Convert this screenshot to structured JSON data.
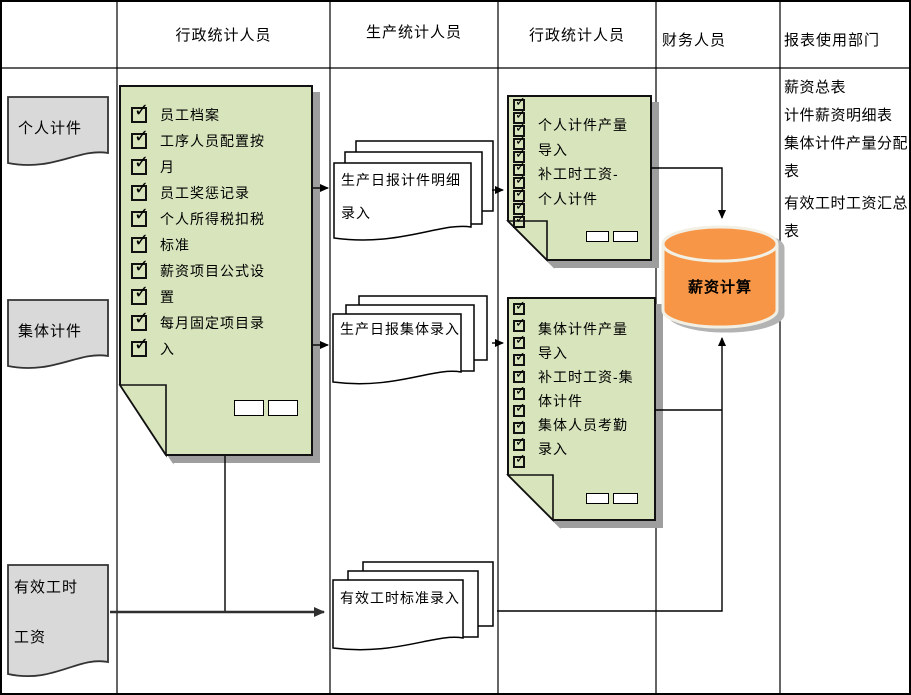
{
  "header": {
    "lanes": [
      "行政统计人员",
      "生产统计人员",
      "行政统计人员",
      "财务人员",
      "报表使用部门"
    ]
  },
  "row_labels": {
    "r1": "个人计件",
    "r2": "集体计件",
    "r3_line1": "有效工时",
    "r3_line2": "工资"
  },
  "admin_master_box": {
    "items": [
      "员工档案",
      "工序人员配置按",
      "月",
      "员工奖惩记录",
      "个人所得税扣税",
      "标准",
      "薪资项目公式设",
      "置",
      "每月固定项目录",
      "入"
    ]
  },
  "production_docs": {
    "doc1_line1": "生产日报计件明细",
    "doc1_line2": "录入",
    "doc2": "生产日报集体录入",
    "doc3": "有效工时标准录入"
  },
  "admin_import_box1": {
    "items": [
      "个人计件产量",
      "导入",
      "补工时工资-",
      "个人计件"
    ]
  },
  "admin_import_box2": {
    "items": [
      "集体计件产量",
      "导入",
      "补工时工资-集",
      "体计件",
      "集体人员考勤",
      "录入"
    ]
  },
  "finance": {
    "cylinder_label": "薪资计算"
  },
  "reports": {
    "items": [
      "薪资总表",
      "计件薪资明细表",
      "集体计件产量分配表",
      "有效工时工资汇总表"
    ]
  },
  "colors": {
    "note_green": "#d7e4bc",
    "cylinder_orange": "#f79646",
    "doc_gray": "#d9d9d9",
    "shadow_gray": "#9e9e9e",
    "line_black": "#000000"
  }
}
